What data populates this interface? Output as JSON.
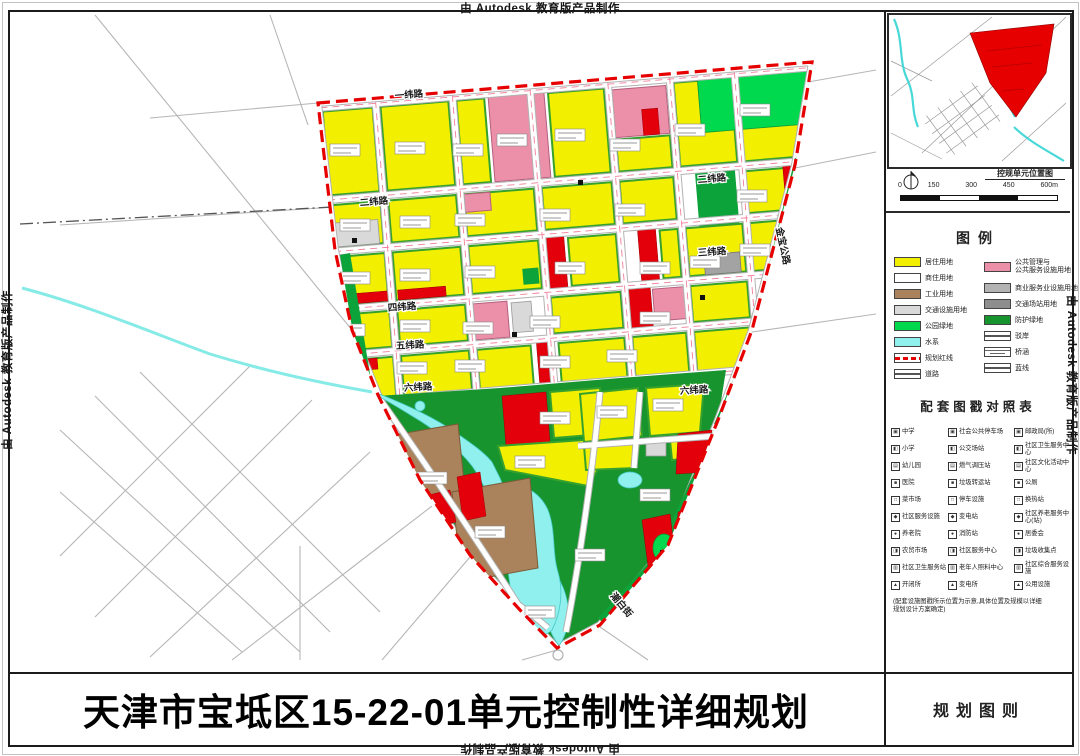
{
  "watermark": {
    "text": "由 Autodesk 教育版产品制作"
  },
  "title_bar": {
    "title": "天津市宝坻区15-22-01单元控制性详细规划",
    "sheet_label": "规划图则"
  },
  "inset": {
    "caption": "控规单元位置图",
    "scale_ticks": [
      "0",
      "150",
      "300",
      "450",
      "600m"
    ],
    "unit_color": "#e60000"
  },
  "legend": {
    "title": "图例",
    "left": [
      {
        "name": "residential-land",
        "label": "居住用地",
        "swatch": "fill",
        "color": "#f3ef00"
      },
      {
        "name": "commercial-residential-land",
        "label": "商住用地",
        "swatch": "fill",
        "color": "#ffffff"
      },
      {
        "name": "industrial-land",
        "label": "工业用地",
        "swatch": "fill",
        "color": "#aa835c"
      },
      {
        "name": "transport-facility-land",
        "label": "交通设施用地",
        "swatch": "fill",
        "color": "#d9d9d9"
      },
      {
        "name": "park-green-land",
        "label": "公园绿地",
        "swatch": "fill",
        "color": "#00d84e"
      },
      {
        "name": "water-system",
        "label": "水系",
        "swatch": "fill",
        "color": "#8ff0ee"
      },
      {
        "name": "planning-red-line",
        "label": "规划红线",
        "swatch": "red-dash",
        "color": "#e60000"
      },
      {
        "name": "road",
        "label": "道路",
        "swatch": "line",
        "color": "#555555"
      }
    ],
    "right": [
      {
        "name": "public-admin-service-land",
        "label": "公共管理与",
        "label2": "公共服务设施用地",
        "swatch": "fill",
        "color": "#ec8fa8"
      },
      {
        "name": "commercial-service-land",
        "label": "商业服务业设施用地",
        "swatch": "fill",
        "color": "#b3b3b3"
      },
      {
        "name": "transport-station-land",
        "label": "交通场站用地",
        "swatch": "fill",
        "color": "#8e8e8e"
      },
      {
        "name": "protective-green-land",
        "label": "防护绿地",
        "swatch": "fill",
        "color": "#17942e"
      },
      {
        "name": "revetment",
        "label": "驳岸",
        "swatch": "line",
        "color": "#555555"
      },
      {
        "name": "bridge-culvert",
        "label": "桥涵",
        "swatch": "bridge",
        "color": "#555555"
      },
      {
        "name": "blue-line",
        "label": "蓝线",
        "swatch": "line",
        "color": "#555555"
      }
    ]
  },
  "facility_table": {
    "title": "配套图戳对照表",
    "columns": [
      [
        "中学",
        "小学",
        "幼儿园",
        "医院",
        "菜市场",
        "社区服务设施",
        "养老院",
        "农贸市场",
        "社区卫生服务站",
        "开闭所"
      ],
      [
        "社会公共停车场",
        "公交场站",
        "燃气调压站",
        "垃圾转运站",
        "停车设施",
        "变电站",
        "消防站",
        "社区服务中心",
        "老年人照料中心",
        "变电所"
      ],
      [
        "邮政局(所)",
        "社区卫生服务中心",
        "社区文化活动中心",
        "公厕",
        "换热站",
        "社区养老服务中心(站)",
        "居委会",
        "垃圾收集点",
        "社区综合服务设施",
        "公用设施"
      ]
    ],
    "note": "(配套设施图戳所示位置为示意,具体位置及规模以详细规划设计方案确定)"
  },
  "map": {
    "boundary_color": "#e60000",
    "road_labels": [
      {
        "text": "一纬路",
        "x": 395,
        "y": 99,
        "r": -5
      },
      {
        "text": "二纬路",
        "x": 360,
        "y": 206,
        "r": -5
      },
      {
        "text": "二纬路",
        "x": 698,
        "y": 183,
        "r": -5
      },
      {
        "text": "三纬路",
        "x": 698,
        "y": 256,
        "r": -4
      },
      {
        "text": "四纬路",
        "x": 388,
        "y": 311,
        "r": -4
      },
      {
        "text": "五纬路",
        "x": 396,
        "y": 349,
        "r": -3
      },
      {
        "text": "六纬路",
        "x": 404,
        "y": 391,
        "r": -3
      },
      {
        "text": "六纬路",
        "x": 680,
        "y": 394,
        "r": -3
      },
      {
        "text": "金宝公路",
        "x": 776,
        "y": 228,
        "r": 78
      },
      {
        "text": "潮白街",
        "x": 610,
        "y": 596,
        "r": 50
      }
    ]
  }
}
